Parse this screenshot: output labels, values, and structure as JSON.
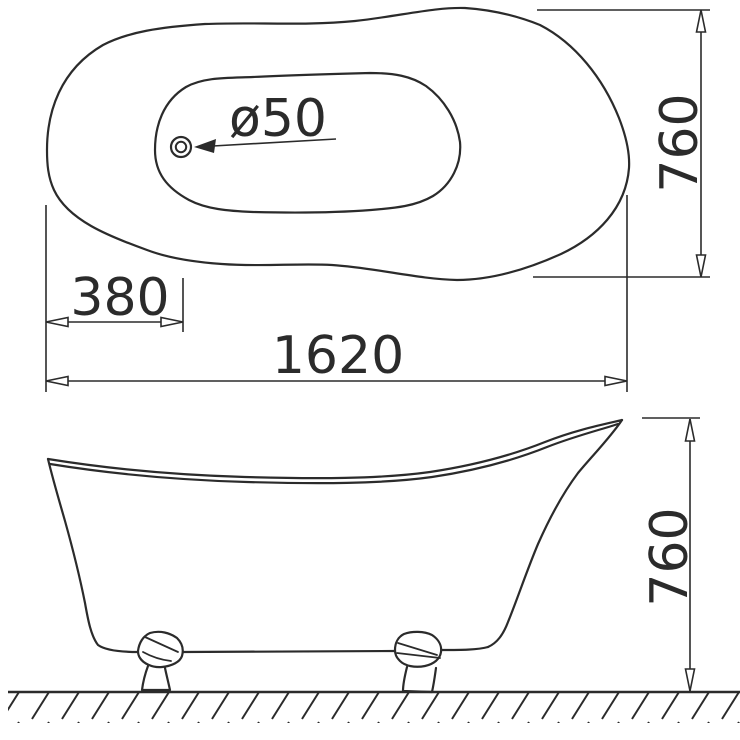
{
  "drawing": {
    "type": "bathtub technical dimension drawing, top view and side elevation",
    "colors": {
      "line": "#2b2b2b",
      "background": "#ffffff"
    },
    "dimensions": {
      "drain_diameter": "ø50",
      "drain_offset": "380",
      "overall_length": "1620",
      "overall_width": "760",
      "overall_height": "760"
    }
  }
}
